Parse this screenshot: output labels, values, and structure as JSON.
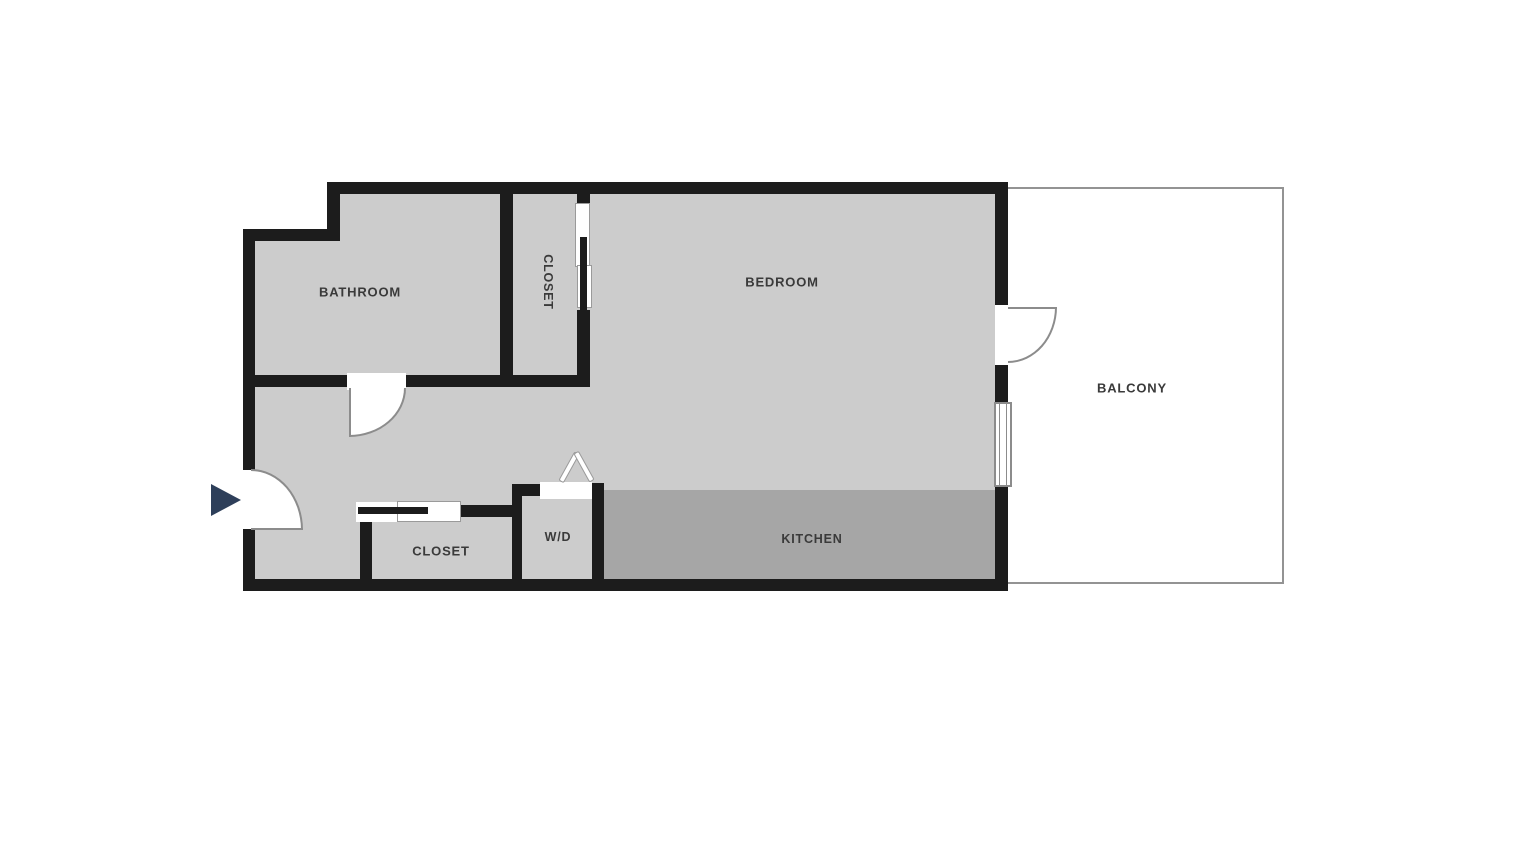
{
  "floorplan": {
    "title": "Apartment floor plan",
    "rooms": [
      {
        "id": "bathroom",
        "label": "BATHROOM"
      },
      {
        "id": "closet_upper",
        "label": "CLOSET"
      },
      {
        "id": "bedroom",
        "label": "BEDROOM"
      },
      {
        "id": "balcony",
        "label": "BALCONY"
      },
      {
        "id": "closet_lower",
        "label": "CLOSET"
      },
      {
        "id": "washer_dryer",
        "label": "W/D"
      },
      {
        "id": "kitchen",
        "label": "KITCHEN"
      }
    ],
    "colors": {
      "background": "#ffffff",
      "wall": "#1c1c1c",
      "floor": "#cccccc",
      "kitchen_floor": "#a6a6a6",
      "balcony_border": "#939393",
      "door_symbol_line": "#8c8c8c",
      "entry_arrow": "#2e3f5a",
      "label_text": "#3a3a3a"
    },
    "icons": {
      "entry_arrow": "right-pointing triangle marking the apartment entrance"
    }
  }
}
